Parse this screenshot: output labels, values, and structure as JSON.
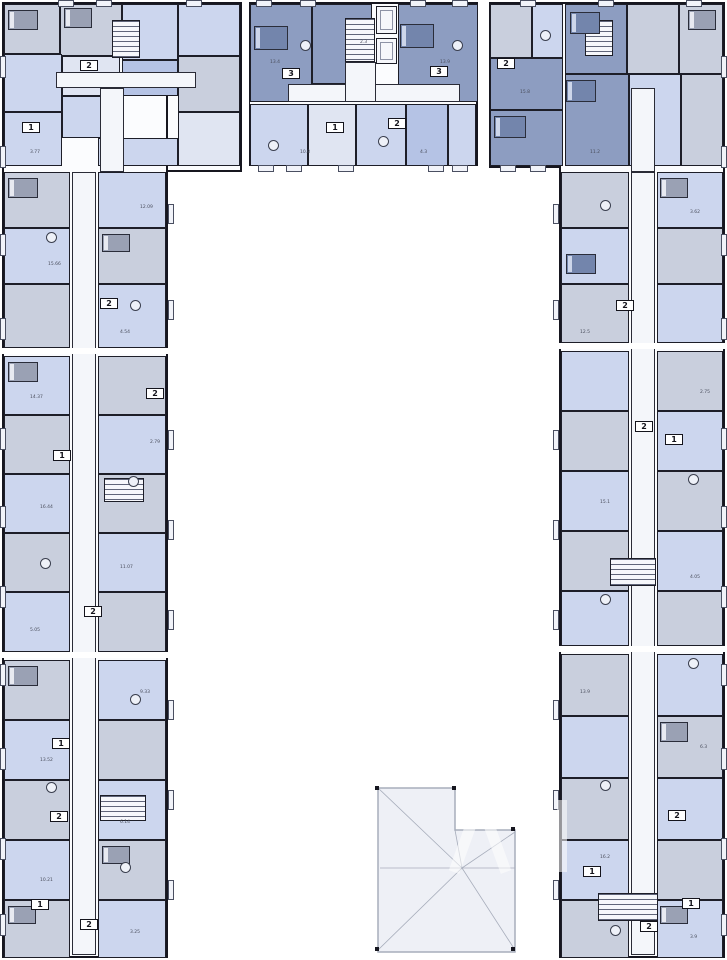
{
  "page": {
    "background": "#ffffff",
    "description_label": "Residential floor plan, U-shaped building with inner courtyard and roof outline"
  },
  "colors": {
    "wall": "#16161f",
    "periwinkle": "#ccd6ee",
    "pale": "#e0e5f2",
    "mid": "#b5c3e5",
    "gray": "#c9cfdd",
    "dark": "#8d9dc1",
    "corridor_white": "#f4f6fa",
    "roof_fill": "#eef0f6",
    "roof_line": "#a7adbb"
  },
  "floorplan": {
    "blocks": [
      [
        2,
        2,
        240,
        170
      ],
      [
        2,
        2,
        166,
        956
      ],
      [
        248,
        2,
        230,
        164
      ],
      [
        488,
        2,
        237,
        166
      ],
      [
        559,
        2,
        166,
        956
      ]
    ],
    "rooms": [
      [
        4,
        4,
        56,
        50,
        "G"
      ],
      [
        60,
        4,
        62,
        52,
        "G"
      ],
      [
        122,
        4,
        56,
        56,
        "P"
      ],
      [
        178,
        4,
        62,
        52,
        "P"
      ],
      [
        178,
        56,
        62,
        56,
        "G"
      ],
      [
        4,
        54,
        58,
        58,
        "P"
      ],
      [
        4,
        112,
        58,
        54,
        "P"
      ],
      [
        62,
        56,
        58,
        40,
        "L"
      ],
      [
        122,
        60,
        56,
        36,
        "M"
      ],
      [
        178,
        112,
        62,
        54,
        "L"
      ],
      [
        62,
        96,
        60,
        42,
        "P"
      ],
      [
        98,
        138,
        80,
        28,
        "P"
      ],
      [
        4,
        172,
        66,
        56,
        "G"
      ],
      [
        4,
        228,
        66,
        56,
        "P"
      ],
      [
        4,
        284,
        66,
        64,
        "G"
      ],
      [
        4,
        356,
        66,
        59,
        "P"
      ],
      [
        4,
        415,
        66,
        59,
        "G"
      ],
      [
        4,
        474,
        66,
        59,
        "P"
      ],
      [
        4,
        533,
        66,
        59,
        "G"
      ],
      [
        4,
        592,
        66,
        60,
        "P"
      ],
      [
        4,
        660,
        66,
        60,
        "G"
      ],
      [
        4,
        720,
        66,
        60,
        "P"
      ],
      [
        4,
        780,
        66,
        60,
        "G"
      ],
      [
        4,
        840,
        66,
        60,
        "P"
      ],
      [
        4,
        900,
        66,
        58,
        "G"
      ],
      [
        98,
        172,
        68,
        56,
        "P"
      ],
      [
        98,
        228,
        68,
        56,
        "G"
      ],
      [
        98,
        284,
        68,
        64,
        "P"
      ],
      [
        98,
        356,
        68,
        59,
        "G"
      ],
      [
        98,
        415,
        68,
        59,
        "P"
      ],
      [
        98,
        474,
        68,
        59,
        "G"
      ],
      [
        98,
        533,
        68,
        59,
        "P"
      ],
      [
        98,
        592,
        68,
        60,
        "G"
      ],
      [
        98,
        660,
        68,
        60,
        "P"
      ],
      [
        98,
        720,
        68,
        60,
        "G"
      ],
      [
        98,
        780,
        68,
        60,
        "P"
      ],
      [
        98,
        840,
        68,
        60,
        "G"
      ],
      [
        98,
        900,
        68,
        58,
        "P"
      ],
      [
        657,
        172,
        66,
        56,
        "P"
      ],
      [
        657,
        228,
        66,
        56,
        "G"
      ],
      [
        657,
        284,
        66,
        59,
        "P"
      ],
      [
        657,
        351,
        66,
        60,
        "G"
      ],
      [
        657,
        411,
        66,
        60,
        "P"
      ],
      [
        657,
        471,
        66,
        60,
        "G"
      ],
      [
        657,
        531,
        66,
        60,
        "P"
      ],
      [
        657,
        591,
        66,
        55,
        "G"
      ],
      [
        657,
        654,
        66,
        62,
        "P"
      ],
      [
        657,
        716,
        66,
        62,
        "G"
      ],
      [
        657,
        778,
        66,
        62,
        "P"
      ],
      [
        657,
        840,
        66,
        60,
        "G"
      ],
      [
        657,
        900,
        66,
        58,
        "P"
      ],
      [
        561,
        172,
        68,
        56,
        "G"
      ],
      [
        561,
        228,
        68,
        56,
        "P"
      ],
      [
        561,
        284,
        68,
        59,
        "G"
      ],
      [
        561,
        351,
        68,
        60,
        "P"
      ],
      [
        561,
        411,
        68,
        60,
        "G"
      ],
      [
        561,
        471,
        68,
        60,
        "P"
      ],
      [
        561,
        531,
        68,
        60,
        "G"
      ],
      [
        561,
        591,
        68,
        55,
        "P"
      ],
      [
        561,
        654,
        68,
        62,
        "G"
      ],
      [
        561,
        716,
        68,
        62,
        "P"
      ],
      [
        561,
        778,
        68,
        62,
        "G"
      ],
      [
        561,
        840,
        68,
        60,
        "P"
      ],
      [
        561,
        900,
        68,
        58,
        "G"
      ],
      [
        250,
        4,
        62,
        98,
        "D"
      ],
      [
        312,
        4,
        60,
        80,
        "D"
      ],
      [
        398,
        4,
        80,
        98,
        "D"
      ],
      [
        250,
        104,
        58,
        62,
        "P"
      ],
      [
        308,
        104,
        48,
        62,
        "L"
      ],
      [
        356,
        104,
        50,
        62,
        "P"
      ],
      [
        406,
        104,
        42,
        62,
        "M"
      ],
      [
        448,
        104,
        28,
        62,
        "P"
      ],
      [
        490,
        4,
        42,
        54,
        "G"
      ],
      [
        532,
        4,
        31,
        54,
        "P"
      ],
      [
        490,
        58,
        73,
        52,
        "D"
      ],
      [
        490,
        110,
        73,
        56,
        "D"
      ],
      [
        565,
        4,
        62,
        70,
        "D"
      ],
      [
        627,
        4,
        52,
        70,
        "G"
      ],
      [
        679,
        4,
        44,
        70,
        "G"
      ],
      [
        565,
        74,
        64,
        92,
        "D"
      ],
      [
        629,
        74,
        52,
        92,
        "P"
      ],
      [
        681,
        74,
        42,
        92,
        "G"
      ]
    ],
    "corridors": [
      [
        56,
        72,
        140,
        16
      ],
      [
        100,
        88,
        24,
        84
      ],
      [
        72,
        172,
        24,
        783
      ],
      [
        631,
        88,
        24,
        84
      ],
      [
        631,
        172,
        24,
        783
      ],
      [
        288,
        84,
        172,
        18
      ],
      [
        345,
        62,
        31,
        40
      ]
    ],
    "stairs": [
      [
        112,
        20,
        28,
        38
      ],
      [
        345,
        18,
        30,
        44
      ],
      [
        585,
        20,
        28,
        36
      ],
      [
        104,
        478,
        40,
        24
      ],
      [
        100,
        795,
        46,
        26
      ],
      [
        610,
        558,
        46,
        28
      ],
      [
        598,
        893,
        60,
        28
      ]
    ],
    "lifts": [
      [
        376,
        6,
        21,
        28
      ],
      [
        376,
        38,
        21,
        26
      ]
    ],
    "joints": [
      [
        0,
        348,
        172,
        6
      ],
      [
        0,
        652,
        172,
        6
      ],
      [
        555,
        343,
        174,
        6
      ],
      [
        555,
        646,
        174,
        6
      ],
      [
        242,
        0,
        7,
        174
      ],
      [
        478,
        0,
        11,
        172
      ]
    ],
    "balconies": [
      [
        58,
        0,
        16,
        7
      ],
      [
        96,
        0,
        16,
        7
      ],
      [
        186,
        0,
        16,
        7
      ],
      [
        256,
        0,
        16,
        7
      ],
      [
        300,
        0,
        16,
        7
      ],
      [
        410,
        0,
        16,
        7
      ],
      [
        452,
        0,
        16,
        7
      ],
      [
        520,
        0,
        16,
        7
      ],
      [
        598,
        0,
        16,
        7
      ],
      [
        686,
        0,
        16,
        7
      ],
      [
        0,
        56,
        6,
        22
      ],
      [
        0,
        146,
        6,
        22
      ],
      [
        0,
        234,
        6,
        22
      ],
      [
        0,
        318,
        6,
        22
      ],
      [
        0,
        428,
        6,
        22
      ],
      [
        0,
        506,
        6,
        22
      ],
      [
        0,
        586,
        6,
        22
      ],
      [
        0,
        664,
        6,
        22
      ],
      [
        0,
        748,
        6,
        22
      ],
      [
        0,
        838,
        6,
        22
      ],
      [
        0,
        914,
        6,
        22
      ],
      [
        721,
        56,
        6,
        22
      ],
      [
        721,
        146,
        6,
        22
      ],
      [
        721,
        234,
        6,
        22
      ],
      [
        721,
        318,
        6,
        22
      ],
      [
        721,
        428,
        6,
        22
      ],
      [
        721,
        506,
        6,
        22
      ],
      [
        721,
        586,
        6,
        22
      ],
      [
        721,
        664,
        6,
        22
      ],
      [
        721,
        748,
        6,
        22
      ],
      [
        721,
        838,
        6,
        22
      ],
      [
        721,
        914,
        6,
        22
      ],
      [
        168,
        204,
        6,
        20
      ],
      [
        168,
        300,
        6,
        20
      ],
      [
        168,
        430,
        6,
        20
      ],
      [
        168,
        520,
        6,
        20
      ],
      [
        168,
        610,
        6,
        20
      ],
      [
        168,
        700,
        6,
        20
      ],
      [
        168,
        790,
        6,
        20
      ],
      [
        168,
        880,
        6,
        20
      ],
      [
        553,
        204,
        6,
        20
      ],
      [
        553,
        300,
        6,
        20
      ],
      [
        553,
        430,
        6,
        20
      ],
      [
        553,
        520,
        6,
        20
      ],
      [
        553,
        610,
        6,
        20
      ],
      [
        553,
        700,
        6,
        20
      ],
      [
        553,
        790,
        6,
        20
      ],
      [
        553,
        880,
        6,
        20
      ],
      [
        258,
        165,
        16,
        7
      ],
      [
        286,
        165,
        16,
        7
      ],
      [
        338,
        165,
        16,
        7
      ],
      [
        428,
        165,
        16,
        7
      ],
      [
        452,
        165,
        16,
        7
      ],
      [
        500,
        165,
        16,
        7
      ],
      [
        530,
        165,
        16,
        7
      ]
    ],
    "badges": [
      [
        80,
        60,
        "2"
      ],
      [
        282,
        68,
        "3"
      ],
      [
        430,
        66,
        "3"
      ],
      [
        326,
        122,
        "1"
      ],
      [
        388,
        118,
        "2"
      ],
      [
        497,
        58,
        "2"
      ],
      [
        22,
        122,
        "1"
      ],
      [
        100,
        298,
        "2"
      ],
      [
        53,
        450,
        "1"
      ],
      [
        146,
        388,
        "2"
      ],
      [
        84,
        606,
        "2"
      ],
      [
        52,
        738,
        "1"
      ],
      [
        50,
        811,
        "2"
      ],
      [
        31,
        899,
        "1"
      ],
      [
        80,
        919,
        "2"
      ],
      [
        616,
        300,
        "2"
      ],
      [
        665,
        434,
        "1"
      ],
      [
        635,
        421,
        "2"
      ],
      [
        668,
        810,
        "2"
      ],
      [
        583,
        866,
        "1"
      ],
      [
        682,
        898,
        "1"
      ],
      [
        640,
        921,
        "2"
      ]
    ],
    "labels": [
      [
        30,
        150,
        "3.77"
      ],
      [
        140,
        205,
        "12.09"
      ],
      [
        48,
        262,
        "15.66"
      ],
      [
        120,
        330,
        "4.54"
      ],
      [
        30,
        395,
        "14.37"
      ],
      [
        150,
        440,
        "2.79"
      ],
      [
        40,
        505,
        "16.44"
      ],
      [
        120,
        565,
        "11.07"
      ],
      [
        30,
        628,
        "5.05"
      ],
      [
        140,
        690,
        "9.33"
      ],
      [
        40,
        758,
        "13.52"
      ],
      [
        120,
        820,
        "6.14"
      ],
      [
        40,
        878,
        "10.21"
      ],
      [
        130,
        930,
        "3.25"
      ],
      [
        590,
        150,
        "11.2"
      ],
      [
        690,
        210,
        "3.62"
      ],
      [
        580,
        330,
        "12.5"
      ],
      [
        700,
        390,
        "2.75"
      ],
      [
        600,
        500,
        "15.1"
      ],
      [
        690,
        575,
        "4.05"
      ],
      [
        580,
        690,
        "13.9"
      ],
      [
        700,
        745,
        "6.3"
      ],
      [
        600,
        855,
        "16.2"
      ],
      [
        690,
        935,
        "3.9"
      ],
      [
        270,
        60,
        "13.4"
      ],
      [
        360,
        40,
        "2.3"
      ],
      [
        440,
        60,
        "13.9"
      ],
      [
        300,
        150,
        "10.8"
      ],
      [
        420,
        150,
        "4.3"
      ],
      [
        520,
        90,
        "15.8"
      ]
    ],
    "furniture": [
      [
        8,
        10,
        30,
        20,
        "bed"
      ],
      [
        64,
        8,
        28,
        20,
        "bed"
      ],
      [
        254,
        26,
        34,
        24,
        "bed_dark"
      ],
      [
        400,
        24,
        34,
        24,
        "bed_dark"
      ],
      [
        570,
        12,
        30,
        22,
        "bed_dark"
      ],
      [
        688,
        10,
        28,
        20,
        "bed"
      ],
      [
        8,
        178,
        30,
        20,
        "bed"
      ],
      [
        102,
        234,
        28,
        18,
        "bed"
      ],
      [
        8,
        362,
        30,
        20,
        "bed"
      ],
      [
        8,
        666,
        30,
        20,
        "bed"
      ],
      [
        102,
        846,
        28,
        18,
        "bed"
      ],
      [
        660,
        178,
        28,
        20,
        "bed"
      ],
      [
        566,
        254,
        30,
        20,
        "bed_dark"
      ],
      [
        660,
        722,
        28,
        20,
        "bed"
      ],
      [
        494,
        116,
        32,
        22,
        "bed_dark"
      ],
      [
        566,
        80,
        30,
        22,
        "bed_dark"
      ],
      [
        8,
        906,
        28,
        18,
        "bed"
      ],
      [
        660,
        906,
        28,
        18,
        "bed"
      ],
      [
        130,
        300,
        11,
        11,
        "table"
      ],
      [
        46,
        232,
        11,
        11,
        "table"
      ],
      [
        128,
        476,
        11,
        11,
        "table"
      ],
      [
        40,
        558,
        11,
        11,
        "table"
      ],
      [
        130,
        694,
        11,
        11,
        "table"
      ],
      [
        46,
        782,
        11,
        11,
        "table"
      ],
      [
        120,
        862,
        11,
        11,
        "table"
      ],
      [
        600,
        200,
        11,
        11,
        "table"
      ],
      [
        688,
        474,
        11,
        11,
        "table"
      ],
      [
        600,
        594,
        11,
        11,
        "table"
      ],
      [
        688,
        658,
        11,
        11,
        "table"
      ],
      [
        600,
        780,
        11,
        11,
        "table"
      ],
      [
        610,
        925,
        11,
        11,
        "table"
      ],
      [
        268,
        140,
        11,
        11,
        "table"
      ],
      [
        378,
        136,
        11,
        11,
        "table"
      ],
      [
        300,
        40,
        11,
        11,
        "table"
      ],
      [
        452,
        40,
        11,
        11,
        "table"
      ],
      [
        540,
        30,
        11,
        11,
        "table"
      ]
    ],
    "roof": {
      "outline": "M378 788 L455 788 L455 830 L515 830 L515 952 L378 952 Z",
      "lines": [
        [
          378,
          788,
          462,
          868
        ],
        [
          378,
          950,
          462,
          868
        ],
        [
          380,
          868,
          462,
          868
        ],
        [
          455,
          830,
          462,
          868
        ],
        [
          515,
          832,
          462,
          868
        ],
        [
          515,
          950,
          462,
          868
        ],
        [
          462,
          868,
          515,
          868
        ]
      ],
      "ticks": [
        [
          375,
          786
        ],
        [
          375,
          947
        ],
        [
          452,
          786
        ],
        [
          511,
          827
        ],
        [
          511,
          947
        ]
      ]
    },
    "watermark": {
      "present": true
    }
  }
}
